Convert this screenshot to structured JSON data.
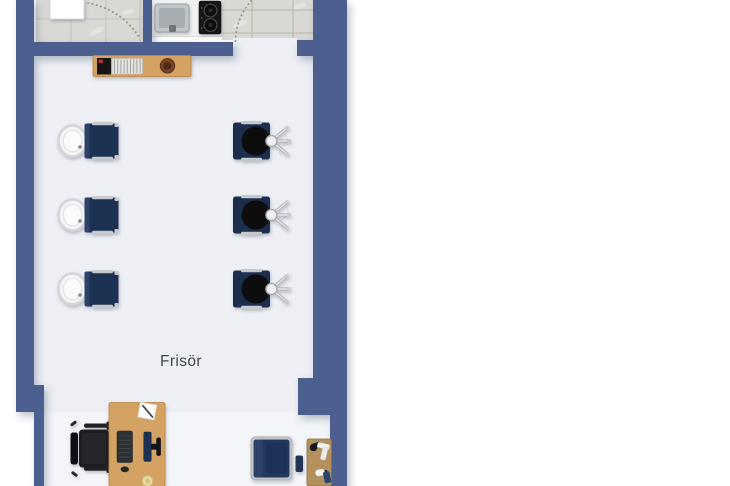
{
  "room": {
    "label": "Frisör"
  },
  "colors": {
    "wall": "#4d5e8e",
    "floor": "#edeff5",
    "tile": "#d9d8d4",
    "grout": "#c3c2bb",
    "grout_green": "#b6b9a4",
    "counter": "#f2f2f0",
    "wood": "#d4a263",
    "wood_dark": "#b3905b",
    "navy": "#1f3252",
    "navy_light": "#2d4269",
    "black": "#17181b",
    "silver": "#c6c9cc",
    "basin": "#fbfbfc",
    "text": "#3e4852"
  },
  "furniture": [
    {
      "name": "magazine-sideboard",
      "count": 1
    },
    {
      "name": "wash-station",
      "count": 3
    },
    {
      "name": "styling-chair",
      "count": 3
    },
    {
      "name": "kitchen-sink",
      "count": 1
    },
    {
      "name": "stove",
      "count": 1
    },
    {
      "name": "reception-desk",
      "count": 1
    },
    {
      "name": "office-chair",
      "count": 1
    },
    {
      "name": "waiting-armchair",
      "count": 1
    },
    {
      "name": "side-table",
      "count": 1
    },
    {
      "name": "door-swing",
      "count": 2
    }
  ]
}
